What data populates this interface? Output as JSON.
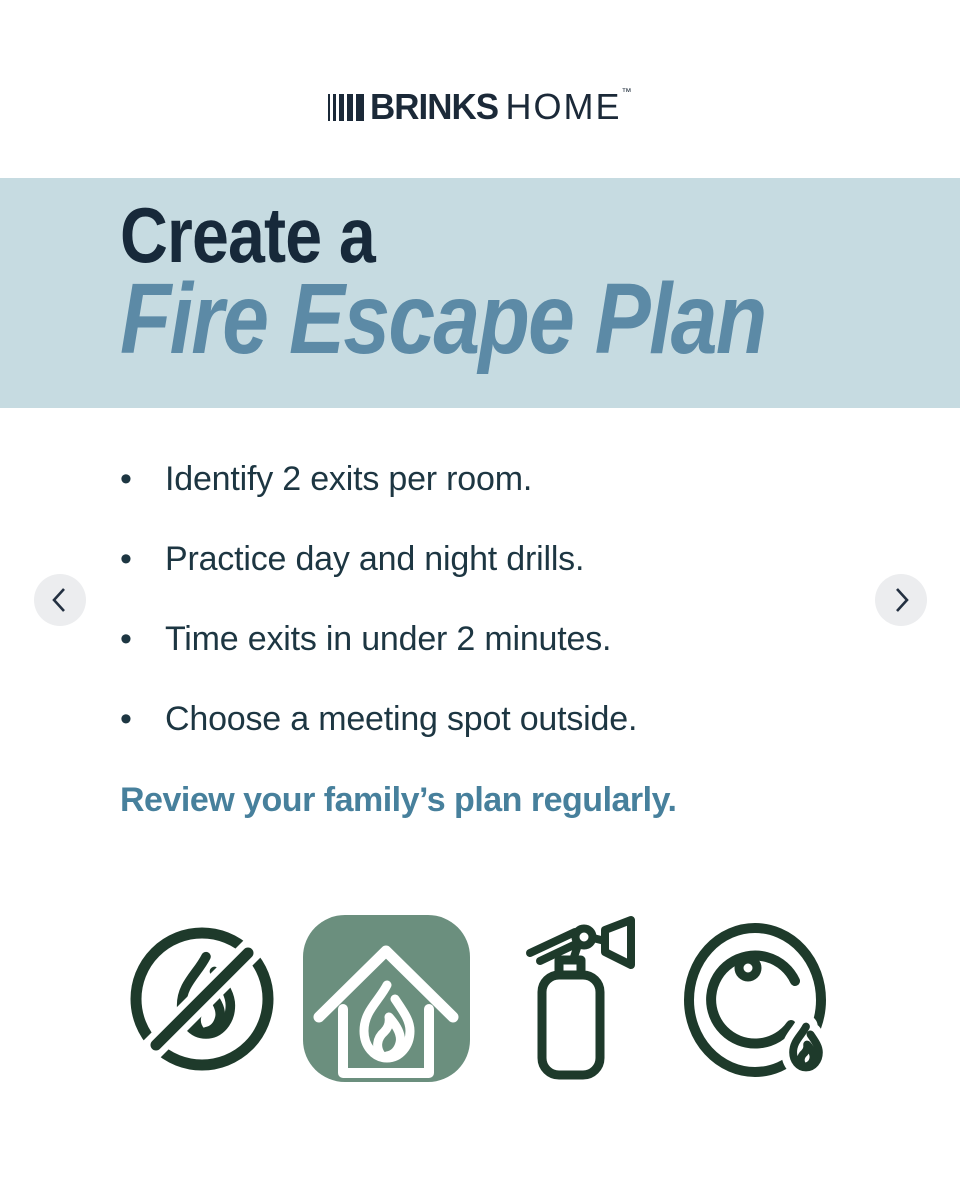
{
  "brand": {
    "bold": "BRINKS",
    "light": "HOME",
    "trademark": "™"
  },
  "banner": {
    "eyebrow": "Create a",
    "title": "Fire Escape Plan"
  },
  "tips": {
    "bullet": "•",
    "items": [
      "Identify 2 exits per room.",
      "Practice day and night drills.",
      "Time exits in under 2 minutes.",
      "Choose a meeting spot outside."
    ],
    "footer": "Review your family’s plan regularly."
  },
  "carousel": {
    "prev_icon": "chevron-left",
    "next_icon": "chevron-right"
  },
  "icons": [
    {
      "name": "no-open-flames-icon"
    },
    {
      "name": "house-fire-icon",
      "style": "green-rounded-tile"
    },
    {
      "name": "fire-extinguisher-icon"
    },
    {
      "name": "fire-alarm-bell-icon"
    }
  ],
  "colors": {
    "banner_bg": "#c6dbe1",
    "headline_dark": "#17293a",
    "headline_accent": "#5c8aa6",
    "body_text": "#1d3642",
    "footer_accent": "#47809c",
    "icon_green": "#1e3a2b",
    "icon_tile_green": "#6b8f7e",
    "nav_circle_bg": "#ecedef",
    "logo_navy": "#1b2938"
  }
}
